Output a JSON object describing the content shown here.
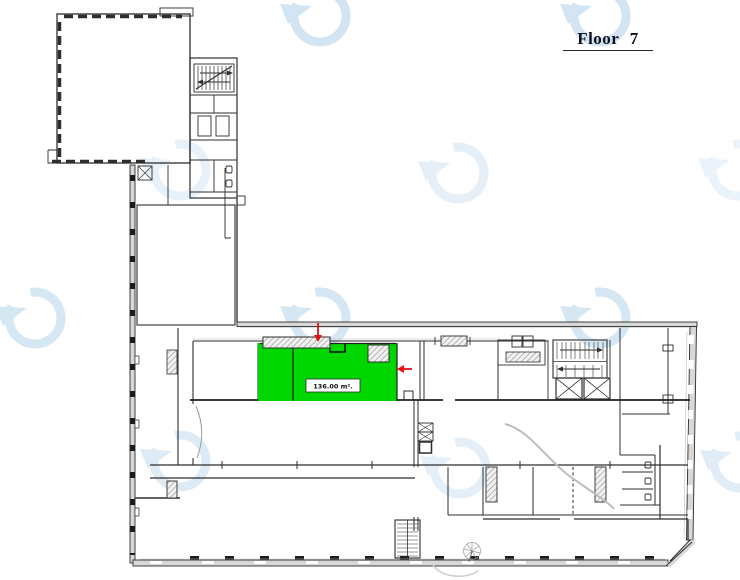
{
  "header": {
    "title": "Floor 7"
  },
  "plan": {
    "unit_label": "136.00 m².",
    "colors": {
      "highlight": "#00d600",
      "arrow": "#e81010",
      "watermark": "#bcd8ee",
      "wall_line": "#2e2e2e",
      "wall_fill": "#d8d8d8"
    }
  }
}
